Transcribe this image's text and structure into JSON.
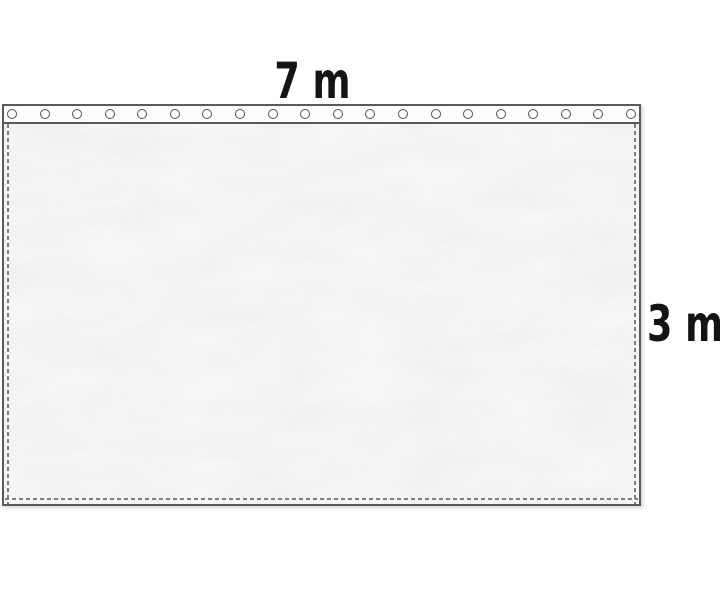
{
  "diagram": {
    "width_label": "7 m",
    "height_label": "3 m",
    "grommet_count": 20,
    "colors": {
      "outline": "#5a5a5a",
      "stitch": "#7e7e7e",
      "label_text": "#141414",
      "fabric": "#f6f7f6",
      "band": "#fdfdfd",
      "eyelet_ring": "#525252",
      "background": "#ffffff"
    }
  }
}
